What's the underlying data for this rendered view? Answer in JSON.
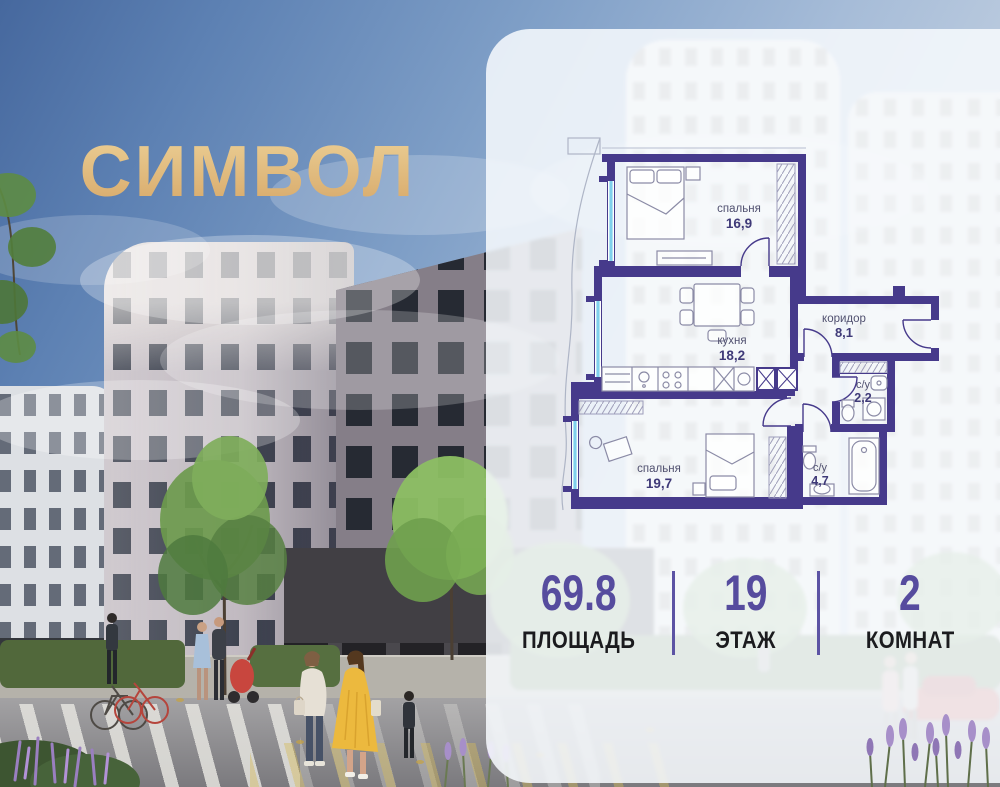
{
  "brand": {
    "logo": "СИМВОЛ",
    "gold_light": "#ecd096",
    "gold_dark": "#d6a768"
  },
  "floor_plan": {
    "wall_color": "#463a8b",
    "window_color": "#7fd0ec",
    "rooms": [
      {
        "label": "спальня",
        "area": "16,9"
      },
      {
        "label": "кухня",
        "area": "18,2"
      },
      {
        "label": "коридор",
        "area": "8,1"
      },
      {
        "label": "с/у",
        "area": "2,2"
      },
      {
        "label": "спальня",
        "area": "19,7"
      },
      {
        "label": "с/у",
        "area": "4,7"
      }
    ]
  },
  "stats": {
    "accent_color": "#564c9e",
    "area": {
      "value": "69.8",
      "label": "ПЛОЩАДЬ"
    },
    "floor": {
      "value": "19",
      "label": "ЭТАЖ"
    },
    "rooms": {
      "value": "2",
      "label": "КОМНАТ"
    }
  }
}
